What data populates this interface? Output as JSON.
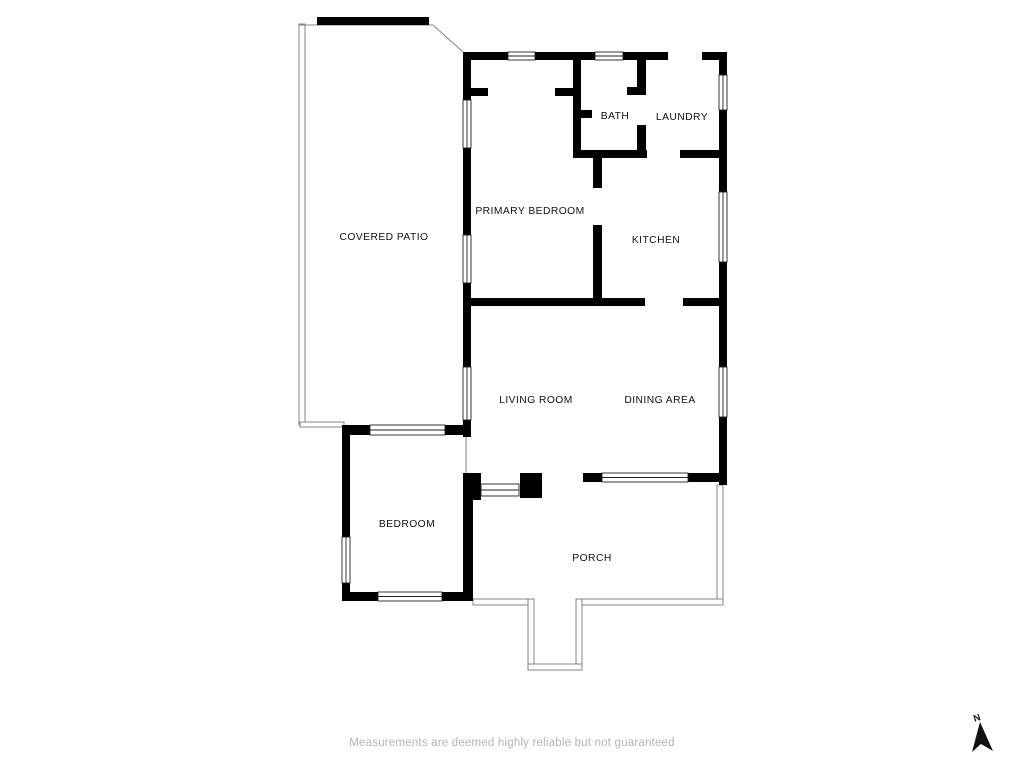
{
  "floorplan": {
    "disclaimer": "Measurements are deemed highly reliable but not guaranteed",
    "compass_label": "N",
    "colors": {
      "background": "#ffffff",
      "wall": "#000000",
      "thin": "#848484",
      "window_stroke": "#222222",
      "label": "#111111",
      "disclaimer": "#b4b4b4"
    },
    "rooms": [
      {
        "id": "covered-patio",
        "label": "COVERED PATIO",
        "x": 384,
        "y": 240
      },
      {
        "id": "primary-bedroom",
        "label": "PRIMARY BEDROOM",
        "x": 530,
        "y": 214
      },
      {
        "id": "bath",
        "label": "BATH",
        "x": 615,
        "y": 119
      },
      {
        "id": "laundry",
        "label": "LAUNDRY",
        "x": 682,
        "y": 120
      },
      {
        "id": "kitchen",
        "label": "KITCHEN",
        "x": 656,
        "y": 243
      },
      {
        "id": "living-room",
        "label": "LIVING ROOM",
        "x": 536,
        "y": 403
      },
      {
        "id": "dining-area",
        "label": "DINING AREA",
        "x": 660,
        "y": 403
      },
      {
        "id": "bedroom",
        "label": "BEDROOM",
        "x": 407,
        "y": 527
      },
      {
        "id": "porch",
        "label": "PORCH",
        "x": 592,
        "y": 561
      }
    ],
    "walls": [
      [
        317,
        17,
        112,
        8
      ],
      [
        463,
        52,
        45,
        8
      ],
      [
        535,
        52,
        60,
        8
      ],
      [
        623,
        52,
        45,
        8
      ],
      [
        702,
        52,
        25,
        8
      ],
      [
        463,
        52,
        8,
        48
      ],
      [
        463,
        148,
        8,
        87
      ],
      [
        463,
        283,
        8,
        84
      ],
      [
        463,
        420,
        8,
        17
      ],
      [
        719,
        52,
        8,
        23
      ],
      [
        719,
        110,
        8,
        82
      ],
      [
        719,
        262,
        8,
        105
      ],
      [
        719,
        417,
        8,
        68
      ],
      [
        573,
        52,
        8,
        106
      ],
      [
        471,
        88,
        17,
        8
      ],
      [
        555,
        88,
        18,
        8
      ],
      [
        573,
        110,
        19,
        8
      ],
      [
        637,
        52,
        9,
        43
      ],
      [
        627,
        87,
        10,
        8
      ],
      [
        637,
        125,
        9,
        33
      ],
      [
        573,
        150,
        74,
        8
      ],
      [
        680,
        150,
        47,
        8
      ],
      [
        593,
        158,
        9,
        30
      ],
      [
        593,
        225,
        9,
        77
      ],
      [
        463,
        298,
        182,
        8
      ],
      [
        683,
        298,
        44,
        8
      ],
      [
        463,
        473,
        18,
        10
      ],
      [
        471,
        481,
        10,
        19
      ],
      [
        520,
        473,
        22,
        25
      ],
      [
        583,
        473,
        19,
        9
      ],
      [
        688,
        473,
        39,
        9
      ],
      [
        342,
        425,
        28,
        10
      ],
      [
        445,
        425,
        26,
        10
      ],
      [
        342,
        425,
        8,
        112
      ],
      [
        342,
        583,
        8,
        17
      ],
      [
        342,
        592,
        36,
        9
      ],
      [
        442,
        592,
        31,
        9
      ],
      [
        463,
        475,
        10,
        125
      ]
    ],
    "windows": [
      [
        508,
        52,
        27,
        8,
        "h"
      ],
      [
        595,
        52,
        28,
        8,
        "h"
      ],
      [
        463,
        100,
        8,
        48,
        "v"
      ],
      [
        463,
        235,
        8,
        48,
        "v"
      ],
      [
        463,
        367,
        8,
        53,
        "v"
      ],
      [
        719,
        75,
        8,
        35,
        "v"
      ],
      [
        719,
        192,
        8,
        70,
        "v"
      ],
      [
        719,
        367,
        8,
        50,
        "v"
      ],
      [
        370,
        425,
        75,
        10,
        "h"
      ],
      [
        342,
        537,
        8,
        46,
        "v"
      ],
      [
        378,
        592,
        64,
        9,
        "h"
      ],
      [
        602,
        473,
        86,
        9,
        "h"
      ],
      [
        481,
        484,
        38,
        12,
        "h"
      ]
    ],
    "thin_rects": [
      [
        299,
        24,
        6,
        401
      ],
      [
        300,
        422,
        44,
        5
      ],
      [
        717,
        485,
        6,
        119
      ],
      [
        473,
        599,
        58,
        6
      ],
      [
        581,
        599,
        142,
        6
      ],
      [
        528,
        599,
        6,
        70
      ],
      [
        576,
        599,
        6,
        70
      ],
      [
        528,
        664,
        54,
        6
      ]
    ],
    "thin_lines": [
      [
        299,
        25,
        433,
        25
      ],
      [
        433,
        25,
        463,
        52
      ],
      [
        466,
        437,
        466,
        475
      ]
    ]
  }
}
